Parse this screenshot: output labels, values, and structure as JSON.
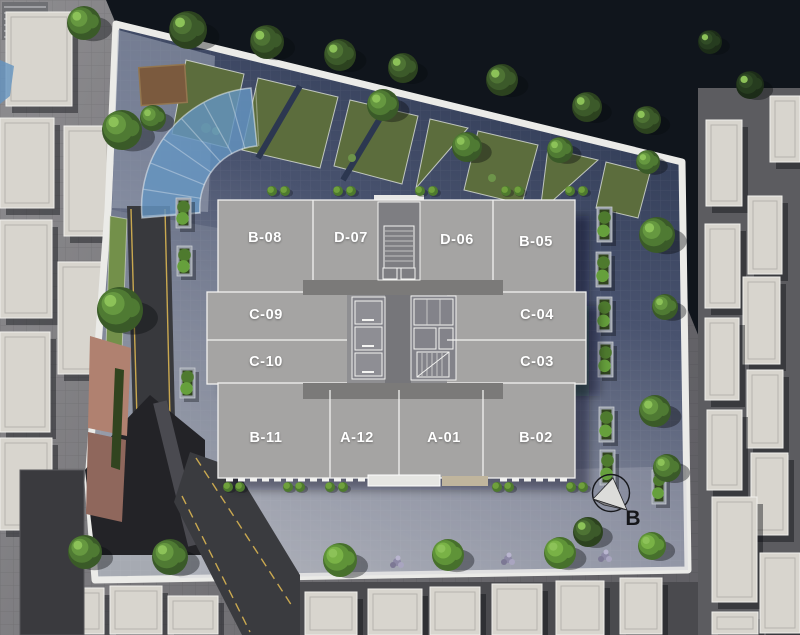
{
  "scene": {
    "type": "architectural-site-plan",
    "view": "top-down master plan rendering"
  },
  "building": {
    "units": [
      {
        "label": "B-08"
      },
      {
        "label": "D-07"
      },
      {
        "label": "D-06"
      },
      {
        "label": "B-05"
      },
      {
        "label": "C-09"
      },
      {
        "label": "C-04"
      },
      {
        "label": "C-10"
      },
      {
        "label": "C-03"
      },
      {
        "label": "B-11"
      },
      {
        "label": "A-12"
      },
      {
        "label": "A-01"
      },
      {
        "label": "B-02"
      }
    ]
  },
  "compass": {
    "label": "B"
  },
  "colors": {
    "unit_slab": "#a5a4a3",
    "corridor": "#7b7a79",
    "courtyard_dark": "#2f3a55",
    "courtyard_light": "#a3a7b0",
    "lawn_green": "#5c6d3d",
    "canopy_blue": "#6494c0",
    "roof_light": "#d8d5ce",
    "asphalt": "#38393d",
    "road_marking_yellow": "#c9a850",
    "terracotta": "#b08170",
    "street_dark": "#10151c",
    "label_text": "#ffffff",
    "compass_text": "#15161a"
  }
}
